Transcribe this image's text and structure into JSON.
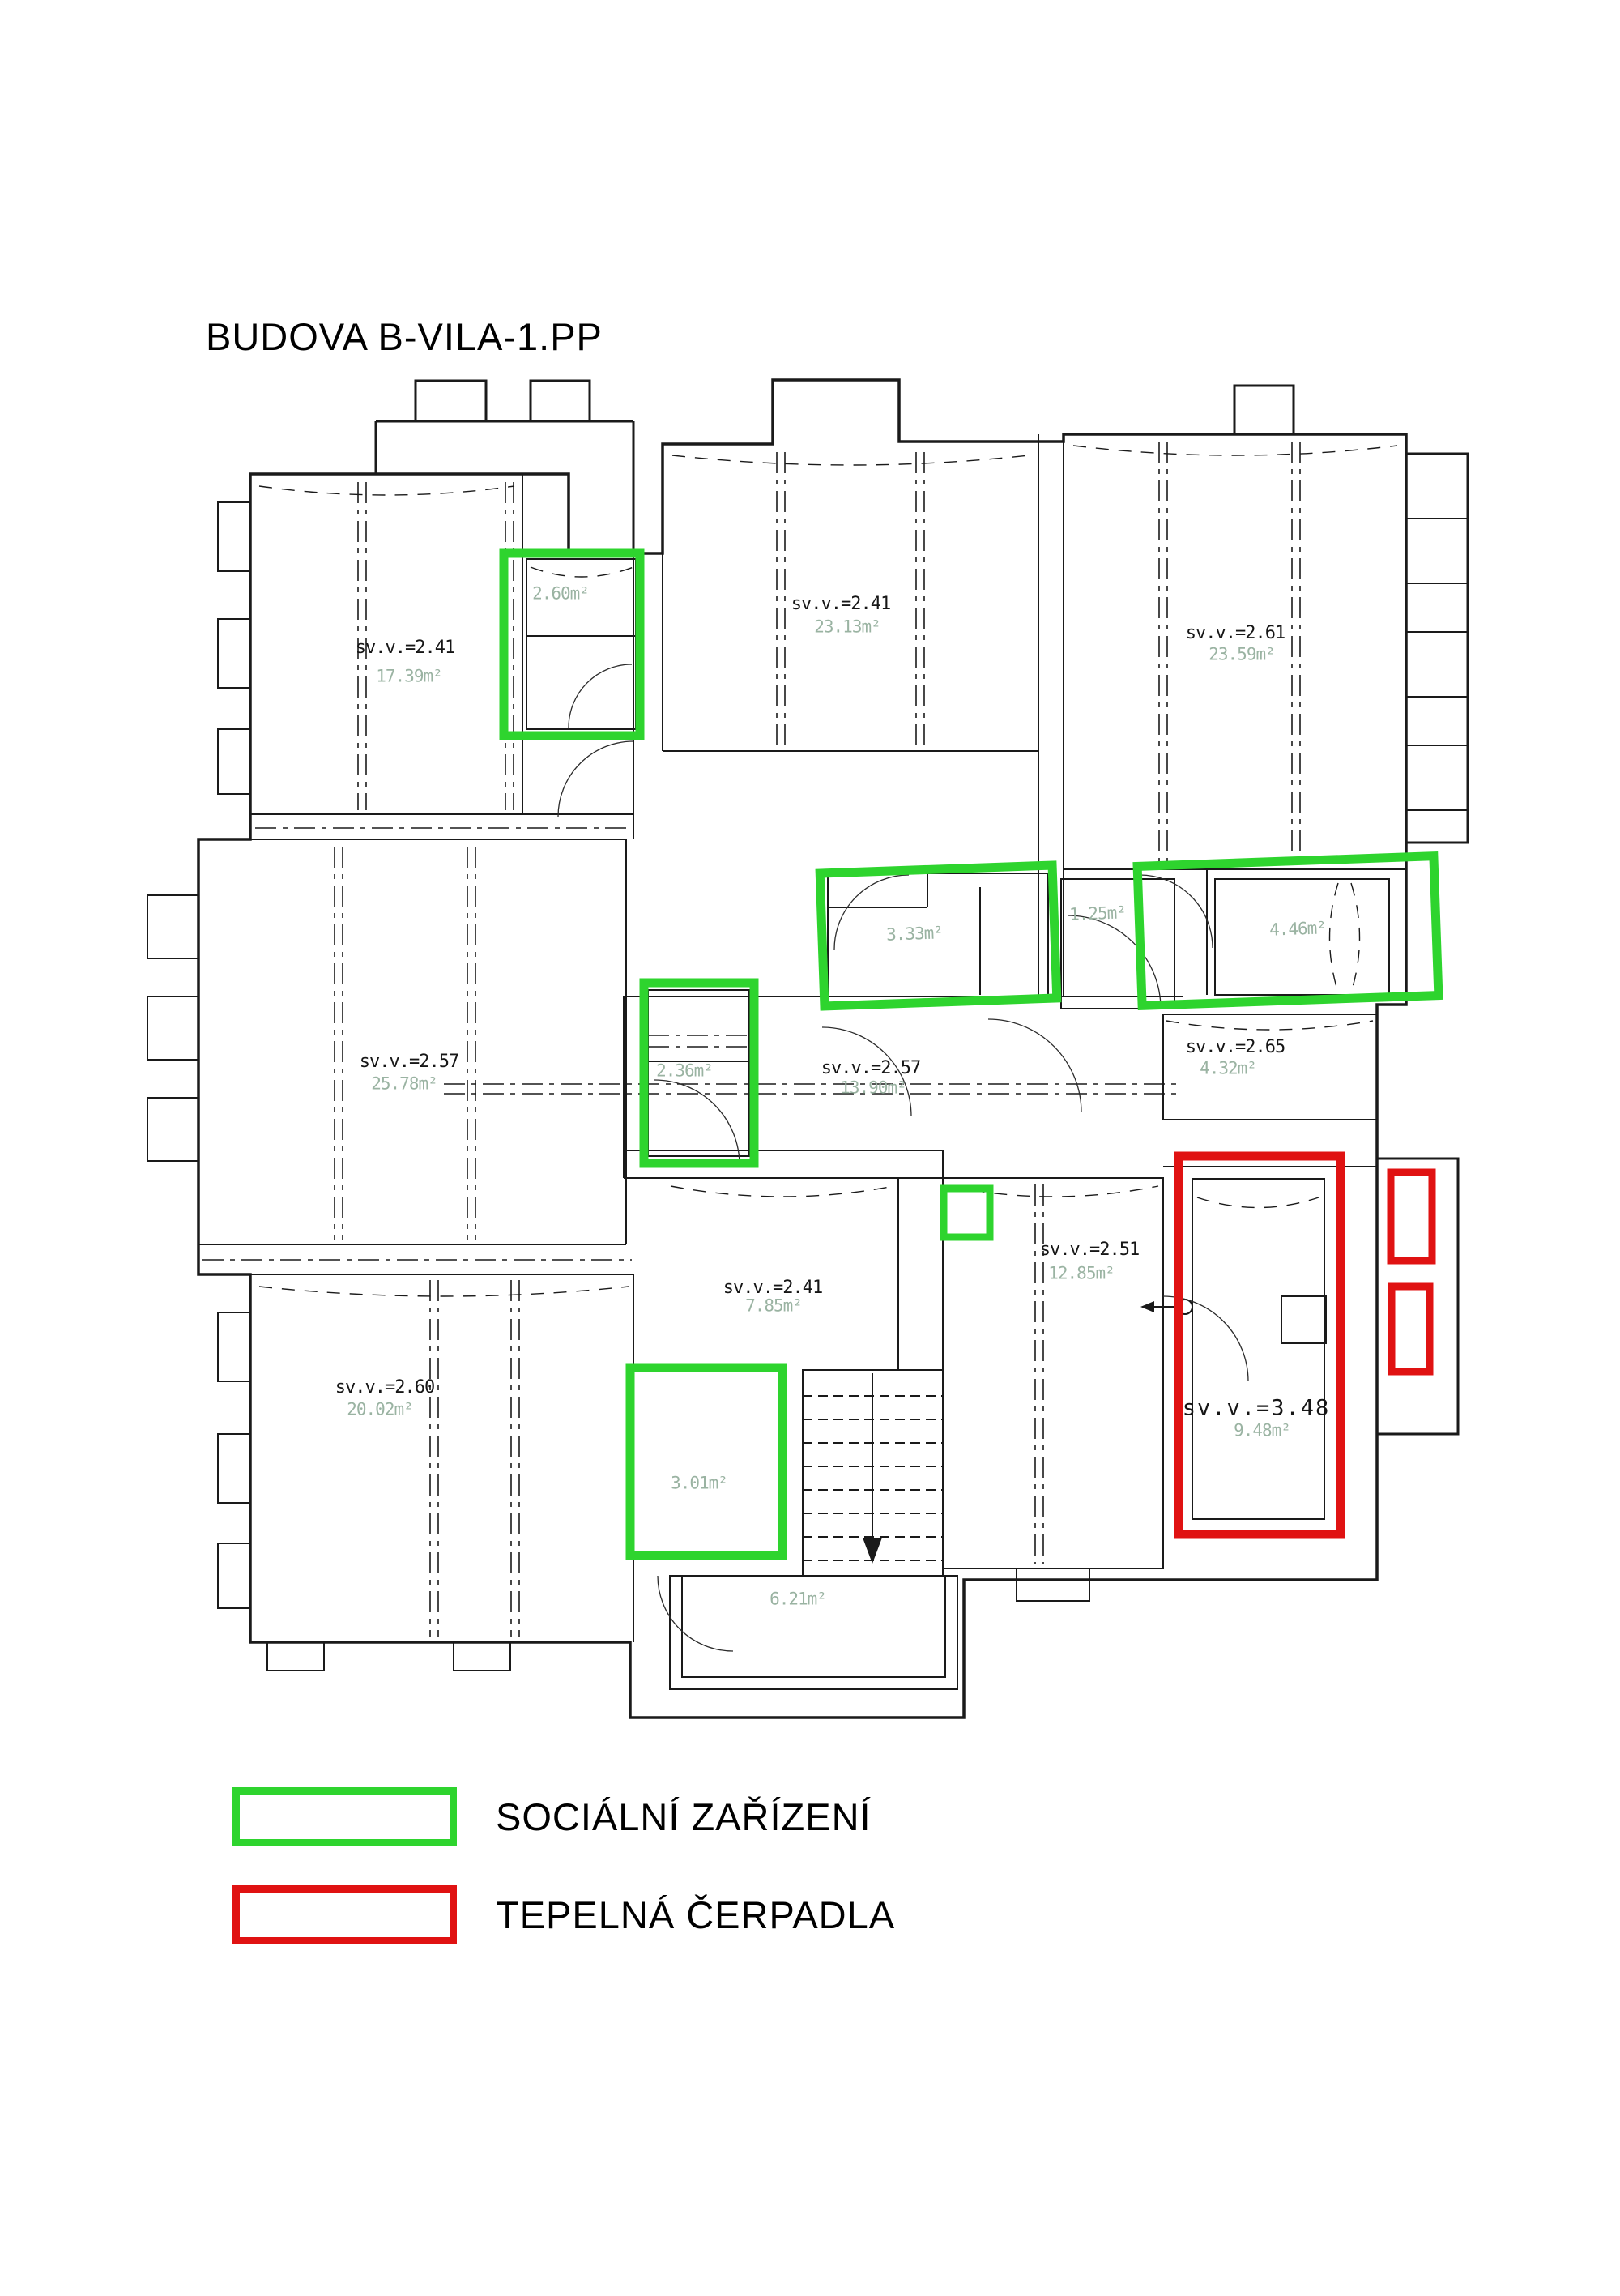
{
  "title": "BUDOVA B-VILA-1.PP",
  "rooms": [
    {
      "name": "room-northwest",
      "height": "sv.v.=2.41",
      "area": "17.39m²"
    },
    {
      "name": "room-north",
      "height": "sv.v.=2.41",
      "area": "23.13m²"
    },
    {
      "name": "room-northeast",
      "height": "sv.v.=2.61",
      "area": "23.59m²"
    },
    {
      "name": "room-west",
      "height": "sv.v.=2.57",
      "area": "25.78m²"
    },
    {
      "name": "corridor",
      "height": "sv.v.=2.57",
      "area": "13.90m²"
    },
    {
      "name": "room-east",
      "height": "sv.v.=2.65",
      "area": "4.32m²"
    },
    {
      "name": "room-southeast",
      "height": "sv.v.=2.51",
      "area": "12.85m²"
    },
    {
      "name": "room-south",
      "height": "sv.v.=2.41",
      "area": "7.85m²"
    },
    {
      "name": "room-southwest",
      "height": "sv.v.=2.60",
      "area": "20.02m²"
    },
    {
      "name": "heat-pump-room",
      "height": "sv.v.=3.48",
      "area": "9.48m²"
    },
    {
      "name": "entry-hall",
      "area": "6.21m²"
    }
  ],
  "sanitary_rooms": [
    {
      "area": "2.60m²"
    },
    {
      "area": "3.33m²"
    },
    {
      "area": "4.46m²"
    },
    {
      "area": "2.36m²"
    },
    {
      "area": "3.01m²"
    }
  ],
  "small_room_area": "1.25m²",
  "legend": [
    {
      "label": "SOCIÁLNÍ ZAŘÍZENÍ",
      "color": "#2ed42e"
    },
    {
      "label": "TEPELNÁ ČERPADLA",
      "color": "#e01212"
    }
  ],
  "colors": {
    "sanitary_outline": "#2ed42e",
    "heat_pump_outline": "#e01212",
    "wall": "#1a1a1a",
    "area_text": "#9ab3a2"
  }
}
